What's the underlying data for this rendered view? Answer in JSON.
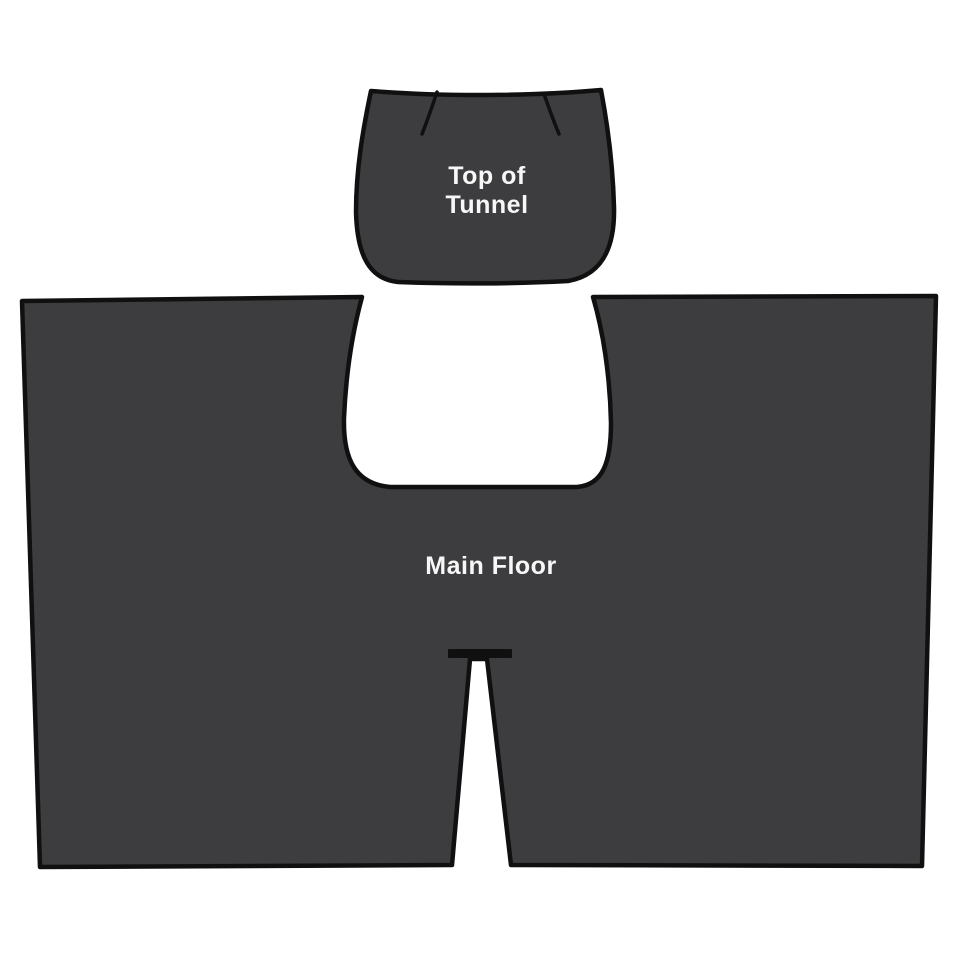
{
  "diagram": {
    "background_color": "#ffffff",
    "outline_color": "#101010",
    "piece_fill_color": "#3d3d3f",
    "label_color": "#f7f7f7",
    "pieces": {
      "tunnel": {
        "name": "Top of Tunnel",
        "label_line1": "Top of",
        "label_line2": "Tunnel"
      },
      "main_floor": {
        "name": "Main Floor",
        "label": "Main Floor"
      }
    }
  }
}
